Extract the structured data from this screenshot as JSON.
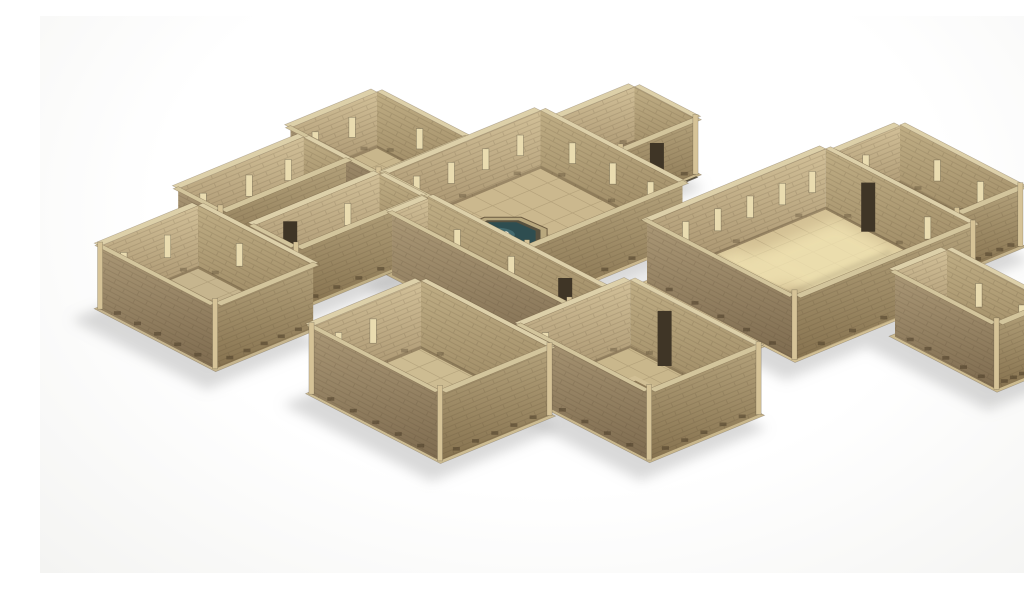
{
  "scene": {
    "description": "3D render of a modular fantasy dungeon tabletop terrain set viewed from above at an angle on a white studio background: interconnected stone rooms and corridors with tiled floors, a central hall containing an octagonal fountain with dark teal water, a small top room with a descending staircase, a large right-hand hall with a sunken stair recess lit by warm sunlight, a bottom room with a dark rectangular floor pit, a far-left room with a circular floor marking, and long narrow corridors, all in sandy tan stone with white seams between modules",
    "background": {
      "top": "#ffffff",
      "bottom": "#f2f2f0"
    },
    "palette": {
      "wall_inner_u_top": "#d2c098",
      "wall_inner_u_bottom": "#a28d69",
      "wall_inner_v_top": "#bfad84",
      "wall_inner_v_bottom": "#98845f",
      "wall_outer_u_top": "#b5a37c",
      "wall_outer_u_bottom": "#86724f",
      "wall_outer_v_top": "#ab9876",
      "wall_outer_v_bottom": "#7e6b4f",
      "wall_cap": "#ddd0a9",
      "wall_cap_near": "#d3c59c",
      "grout": "#7d6b4c",
      "tick": "#463723",
      "slot": "#eadcb0",
      "doorway": "#3f3526",
      "post": "#d6c397",
      "water_rim": "#b9a87e",
      "water_ring": "#57503e",
      "water_deep": "#2e4d50",
      "water_light": "#477074",
      "statue": "#eee3bd",
      "statue_hi": "#f6efd6",
      "pit_dark": "#241c12",
      "pit_rim": "#8f7b58",
      "pit_ring": "#d2c096",
      "recess_deep": "#1d1826",
      "sunlight": "#f4e7b6",
      "shadow": "#9a9a9a",
      "stain": "#6d5a3e"
    },
    "modules": [
      {
        "id": "stairs-room",
        "label": "small room with descending staircase",
        "floor": "#c5b389"
      },
      {
        "id": "top-left-room",
        "label": "small square room",
        "floor": "#c8b68c"
      },
      {
        "id": "top-right-corridor",
        "label": "wide corridor at top right",
        "floor": "#c4b28a"
      },
      {
        "id": "left-corridor-upper",
        "label": "long narrow corridor",
        "floor": "#c2b086"
      },
      {
        "id": "fountain-hall",
        "label": "great hall with octagonal fountain",
        "floor": "#cbb88e"
      },
      {
        "id": "left-corridor-lower",
        "label": "long narrow corridor",
        "floor": "#bfae84"
      },
      {
        "id": "grand-hall",
        "label": "large hall with sunken staircase and sunlight",
        "floor": "#d3c094"
      },
      {
        "id": "middle-corridor",
        "label": "connecting corridor",
        "floor": "#bfad83"
      },
      {
        "id": "east-corridor",
        "label": "corridor at far right",
        "floor": "#cdbb8f"
      },
      {
        "id": "far-left-room",
        "label": "small square room with circular floor marking",
        "floor": "#c6b58e"
      },
      {
        "id": "pit-room",
        "label": "square room with rectangular pit",
        "floor": "#c9b78c"
      },
      {
        "id": "bottom-left-room",
        "label": "square room with worn tiles",
        "floor": "#cdbc92"
      }
    ]
  }
}
